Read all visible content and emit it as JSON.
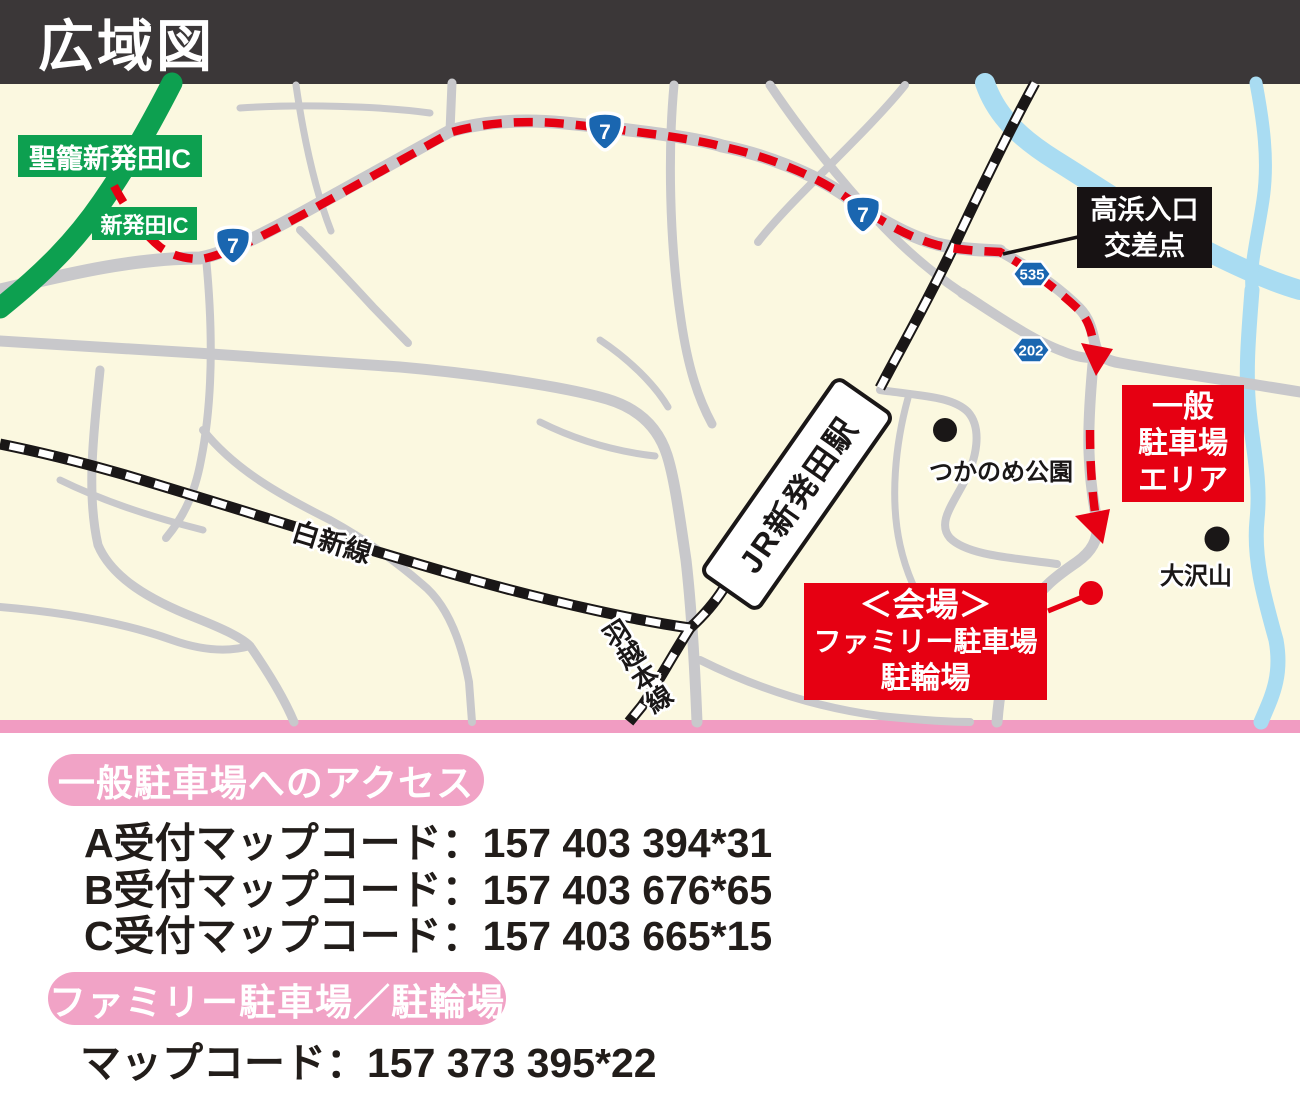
{
  "header": {
    "title": "広域図"
  },
  "map": {
    "expressway_ics": [
      {
        "label": "聖籠新発田IC"
      },
      {
        "label": "新発田IC"
      }
    ],
    "junction": {
      "line1": "高浜入口",
      "line2": "交差点"
    },
    "shields": {
      "route7": "7",
      "route535": "535",
      "route202": "202"
    },
    "station": {
      "label": "JR新発田駅"
    },
    "rail_lines": {
      "hakushin": "白新線",
      "uetsu": "羽越本線"
    },
    "pois": {
      "park": "つかのめ公園",
      "mountain": "大沢山"
    },
    "general_parking_box": {
      "line1": "一般",
      "line2": "駐車場",
      "line3": "エリア"
    },
    "venue_box": {
      "line1": "＜会場＞",
      "line2": "ファミリー駐車場",
      "line3": "駐輪場"
    }
  },
  "access_section": {
    "heading": "一般駐車場へのアクセス",
    "codes": [
      "A受付マップコード：157 403 394*31",
      "B受付マップコード：157 403 676*65",
      "C受付マップコード：157 403 665*15"
    ]
  },
  "family_section": {
    "heading": "ファミリー駐車場／駐輪場",
    "code": "マップコード：157 373 395*22"
  },
  "colors": {
    "accent_red": "#E60012",
    "accent_pink": "#F1A3C6",
    "expressway_green": "#0DA050",
    "route_shield_blue": "#1A66B0",
    "river_blue": "#A9DCF2",
    "map_background": "#FBF8E0",
    "header_background": "#3B3738"
  }
}
